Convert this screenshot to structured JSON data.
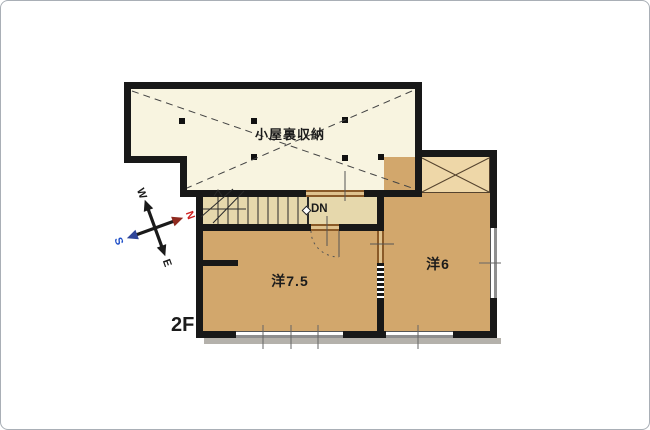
{
  "floor_label": "2F",
  "rooms": {
    "attic": {
      "label": "小屋裏収納"
    },
    "western_7_5": {
      "label": "洋7.5"
    },
    "western_6": {
      "label": "洋6"
    }
  },
  "stairs": {
    "direction_label": "DN"
  },
  "compass": {
    "north": "N",
    "south": "S",
    "east": "E",
    "west": "W"
  },
  "colors": {
    "attic-floor": "#f8f4e0",
    "hall-floor": "#e6d8ac",
    "room-floor": "#d2a76c",
    "closet-floor": "#eed7a8",
    "wall": "#181818",
    "opening-fill": "#dfc28e",
    "opening-frame": "#8a5a28",
    "window-gray": "#8f8f8f",
    "shadow": "#b4b1ab",
    "north-color": "#cf2020",
    "south-color": "#2050c8"
  }
}
